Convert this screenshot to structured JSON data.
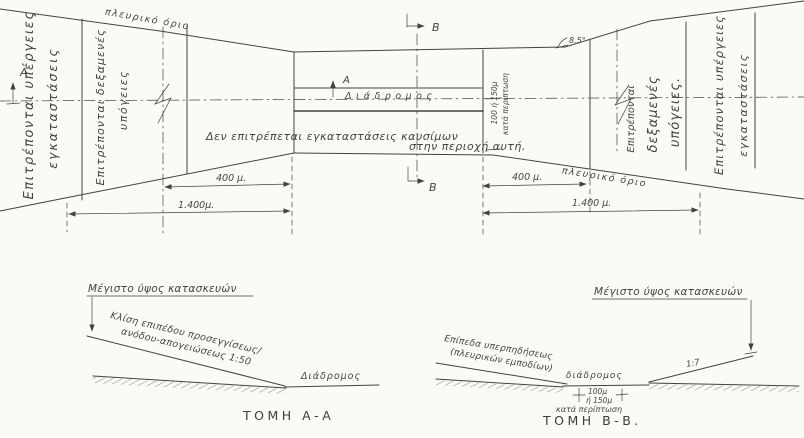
{
  "drawing": {
    "ink_color": "#44423d",
    "paper_color": "#fbfaf7",
    "plan": {
      "left_outer": {
        "l1": "Επιτρέπονται υπέργειες",
        "l2": "εγκαταστάσεις"
      },
      "left_inner": {
        "l1": "Επιτρέπονται δεξαμενές",
        "l2": "υπόγειες"
      },
      "right_inner": {
        "l1": "Επιτρέπονται",
        "l2": "δεξαμενές",
        "l3": "υπόγειες."
      },
      "right_outer": {
        "l1": "Επιτρέπονται υπέργειες",
        "l2": "εγκαταστάσεις"
      },
      "top_edge_label": "πλευρικό όριο",
      "bottom_edge_label": "πλευρικό όριο",
      "runway_label": "Διάδρομος",
      "no_fuel": {
        "l1": "Δεν επιτρέπεται εγκαταστάσεις καυσίμων",
        "l2": "στην περιοχή αυτή."
      },
      "strip": {
        "l1": "100 ή 150μ",
        "l2": "κατά περίπτωση"
      },
      "angle_label": "8.5°",
      "dims": {
        "left_400": "400 μ.",
        "left_1400": "1.400μ.",
        "right_400": "400 μ.",
        "right_1400": "1.400 μ."
      },
      "markers": {
        "a": "Α",
        "b": "Β"
      }
    },
    "section_aa": {
      "title": "Μέγιστο ύψος κατασκευών",
      "slope": {
        "l1": "Κλίση επιπέδου προσεγγίσεως/",
        "l2": "ανόδου-απογειώσεως 1:50"
      },
      "runway_label": "Διάδρομος",
      "caption": "ΤΟΜΗ Α-Α"
    },
    "section_bb": {
      "title": "Μέγιστο ύψος κατασκευών",
      "slope": {
        "l1": "Επίπεδα υπερπηδήσεως",
        "l2": "(πλευρικών εμποδίων)"
      },
      "runway_label": "διάδρομος",
      "dim": {
        "l1": "100μ",
        "l2": "ή 150μ",
        "l3": "κατά περίπτωση"
      },
      "slope_ratio": "1:7",
      "caption": "ΤΟΜΗ Β-Β."
    }
  }
}
